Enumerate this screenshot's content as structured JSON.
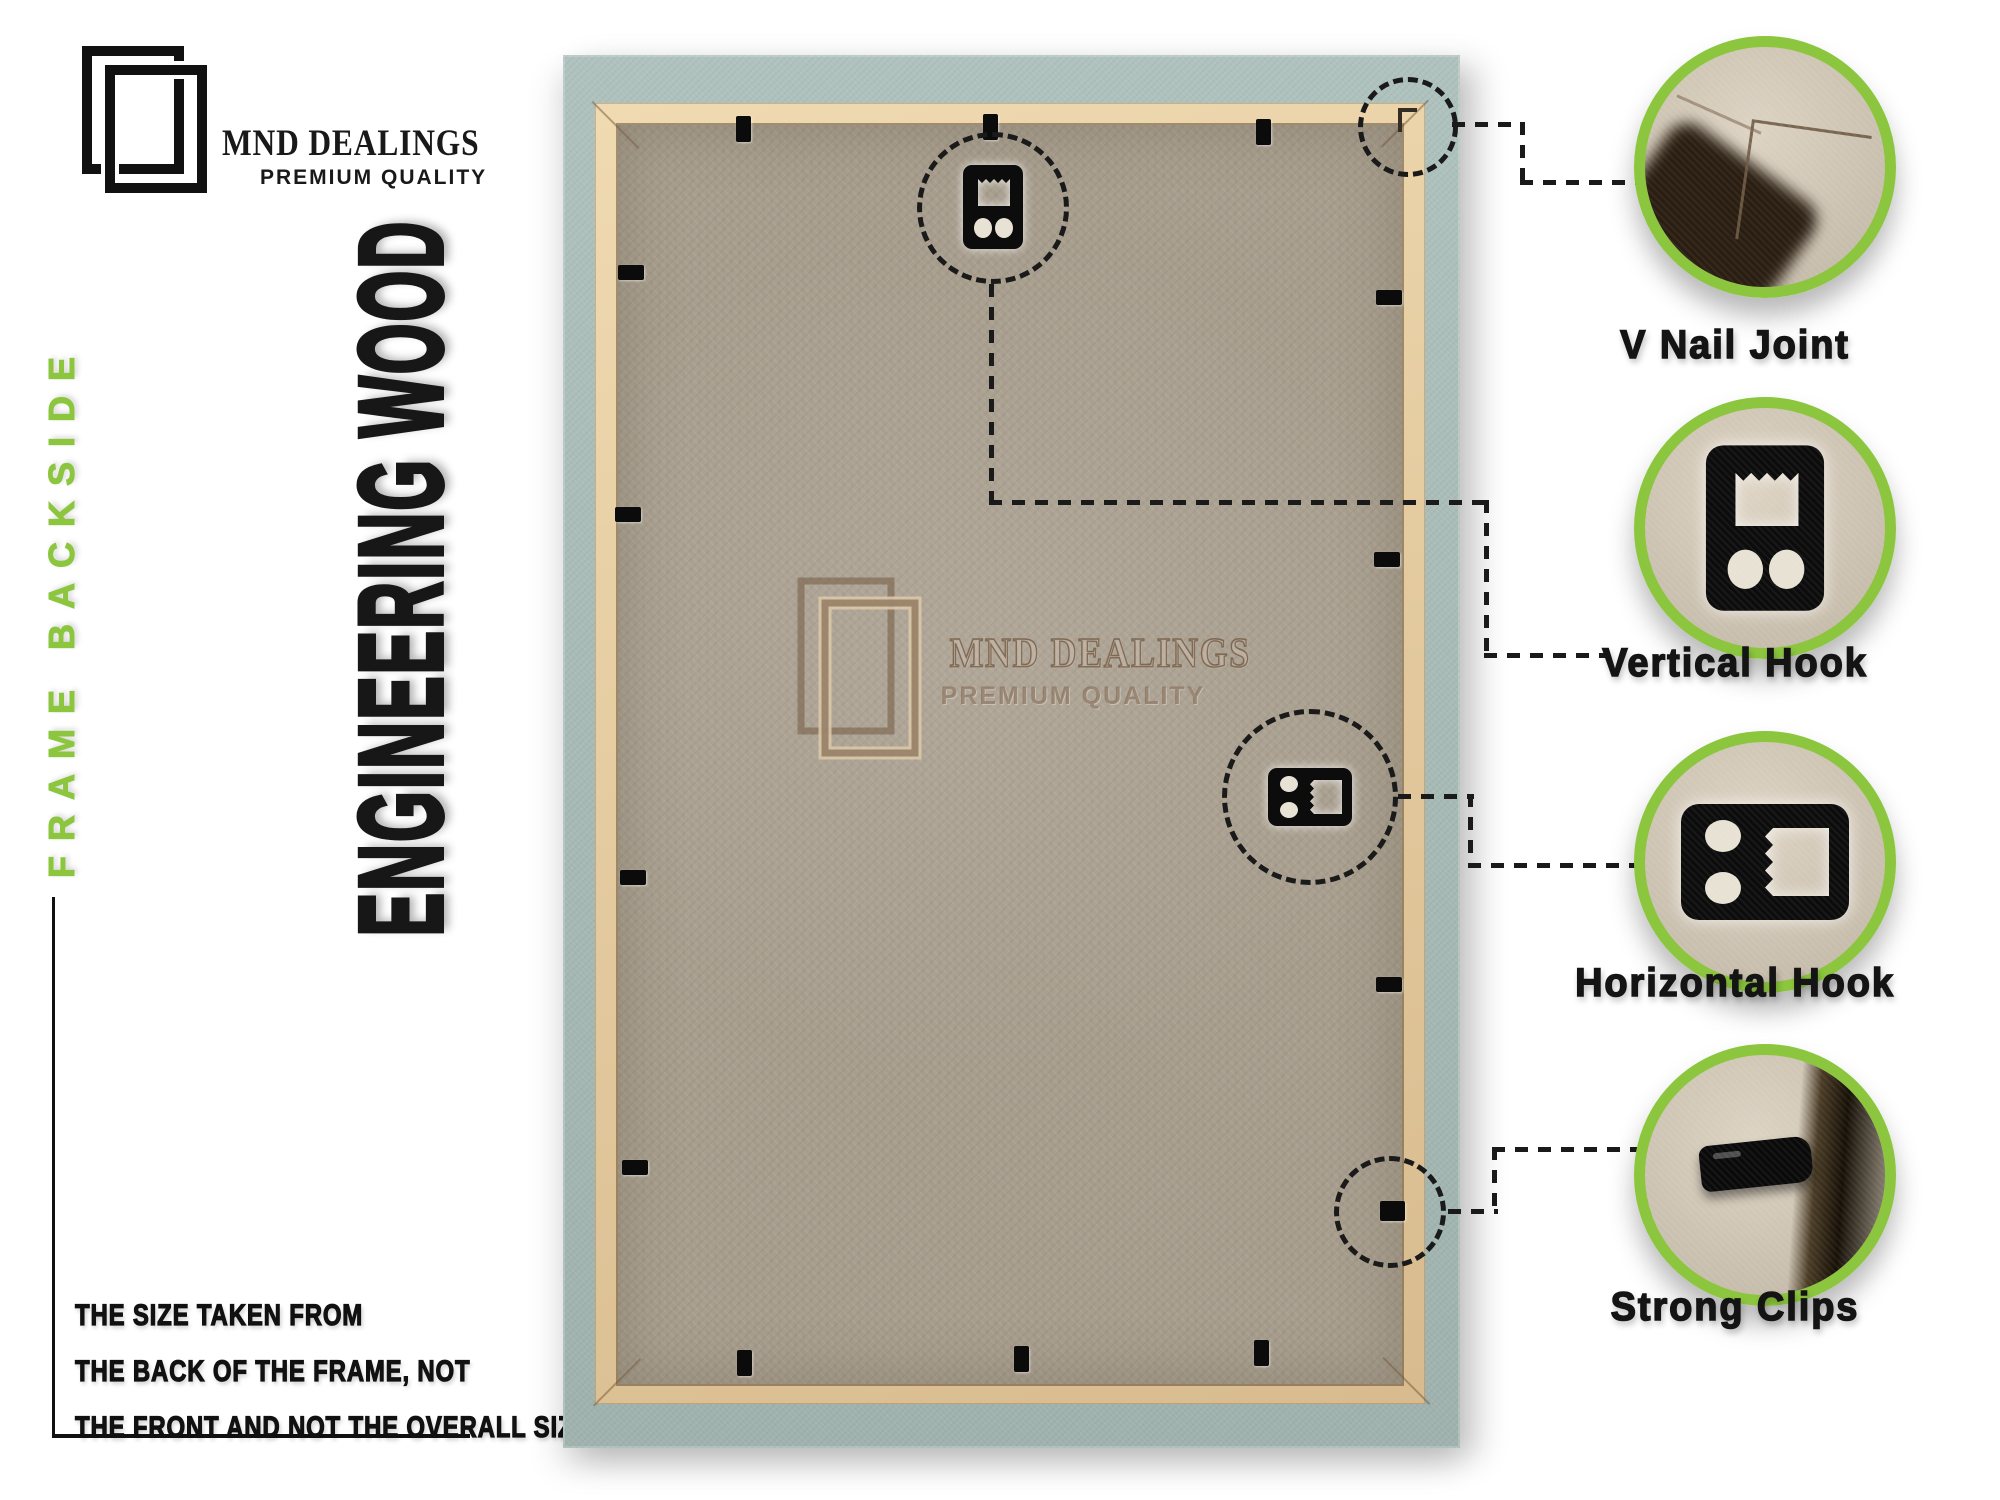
{
  "brand": {
    "name": "MND DEALINGS",
    "tagline": "PREMIUM QUALITY"
  },
  "labels": {
    "side_vertical": "FRAME BACKSIDE",
    "material_vertical": "ENGINEERING WOOD"
  },
  "note": {
    "line1": "THE SIZE TAKEN FROM",
    "line2": "THE BACK OF THE FRAME, NOT",
    "line3": "THE FRONT AND NOT THE OVERALL SIZE."
  },
  "watermark": {
    "name": "MND DEALINGS",
    "tagline": "PREMIUM QUALITY"
  },
  "callouts": [
    {
      "label": "V Nail Joint"
    },
    {
      "label": "Vertical Hook"
    },
    {
      "label": "Horizontal Hook"
    },
    {
      "label": "Strong Clips"
    }
  ],
  "colors": {
    "accent_green": "#8cc63e",
    "frame_teal": "#a9bdb8",
    "frame_border_cream": "#e7cfa7",
    "board_tan": "#a89e8e",
    "ink": "#171717"
  }
}
